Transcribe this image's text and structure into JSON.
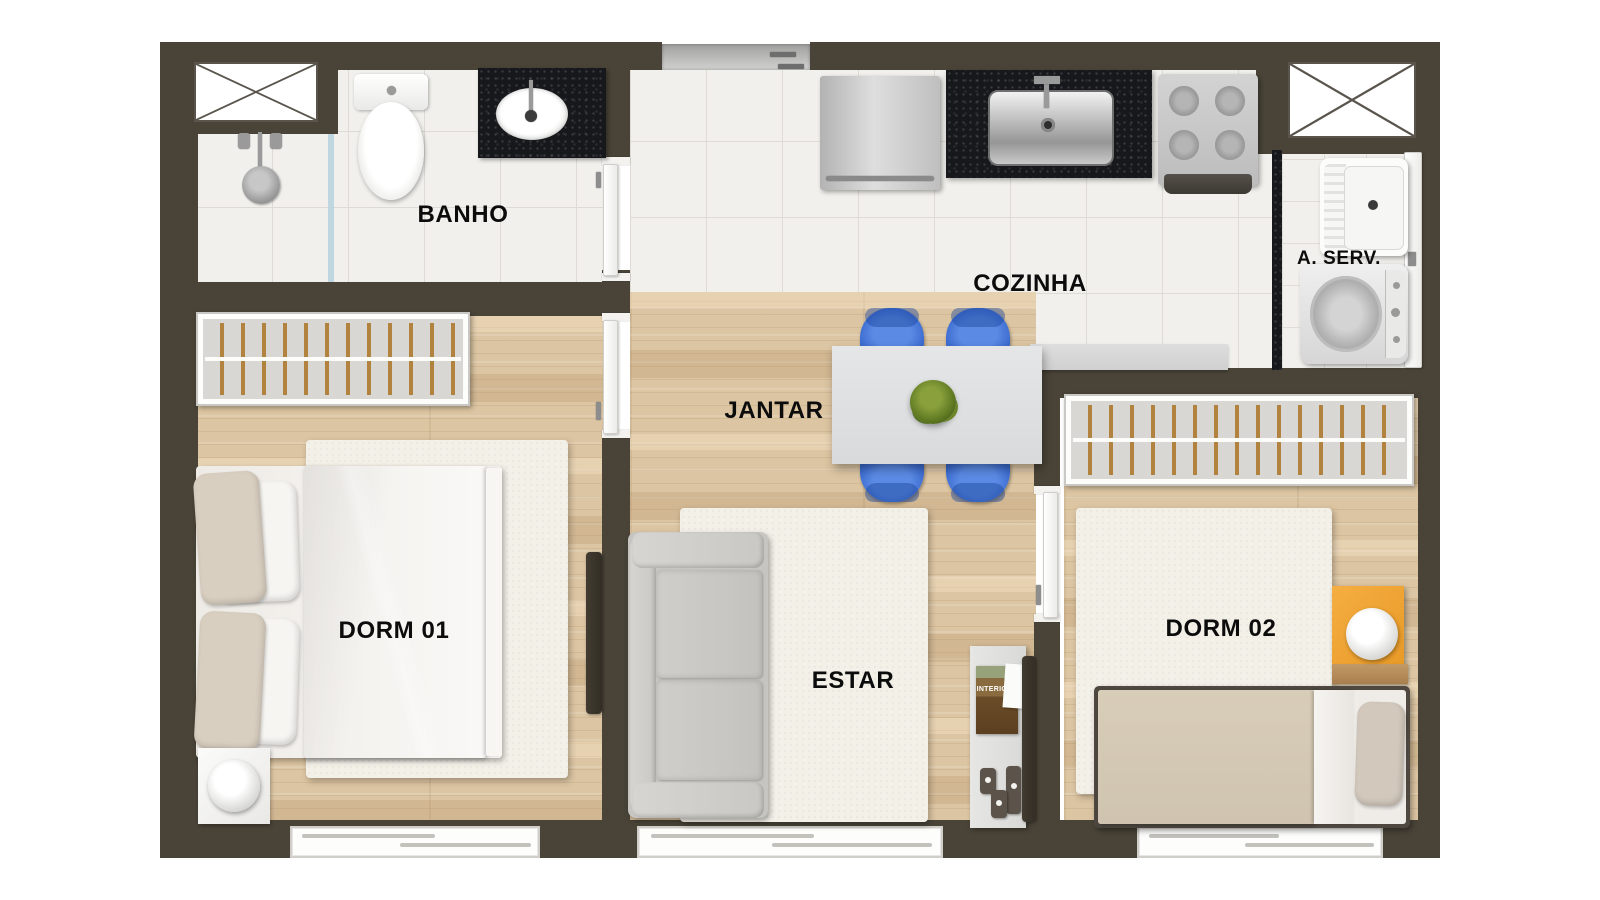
{
  "plan_title": "Apartment floor plan",
  "rooms": {
    "banho": {
      "label": "BANHO"
    },
    "cozinha": {
      "label": "COZINHA"
    },
    "a_serv": {
      "label": "A. SERV."
    },
    "jantar": {
      "label": "JANTAR"
    },
    "dorm01": {
      "label": "DORM 01"
    },
    "estar": {
      "label": "ESTAR"
    },
    "dorm02": {
      "label": "DORM 02"
    }
  },
  "decor": {
    "magazine_title": "INTERIORS"
  },
  "colors": {
    "wall": "#4a4438",
    "wood": "#dcc5a2",
    "tile": "#f1f0ec",
    "granite": "#17181c",
    "chair": "#3f6fd2",
    "nightstand": "#f0a437"
  }
}
